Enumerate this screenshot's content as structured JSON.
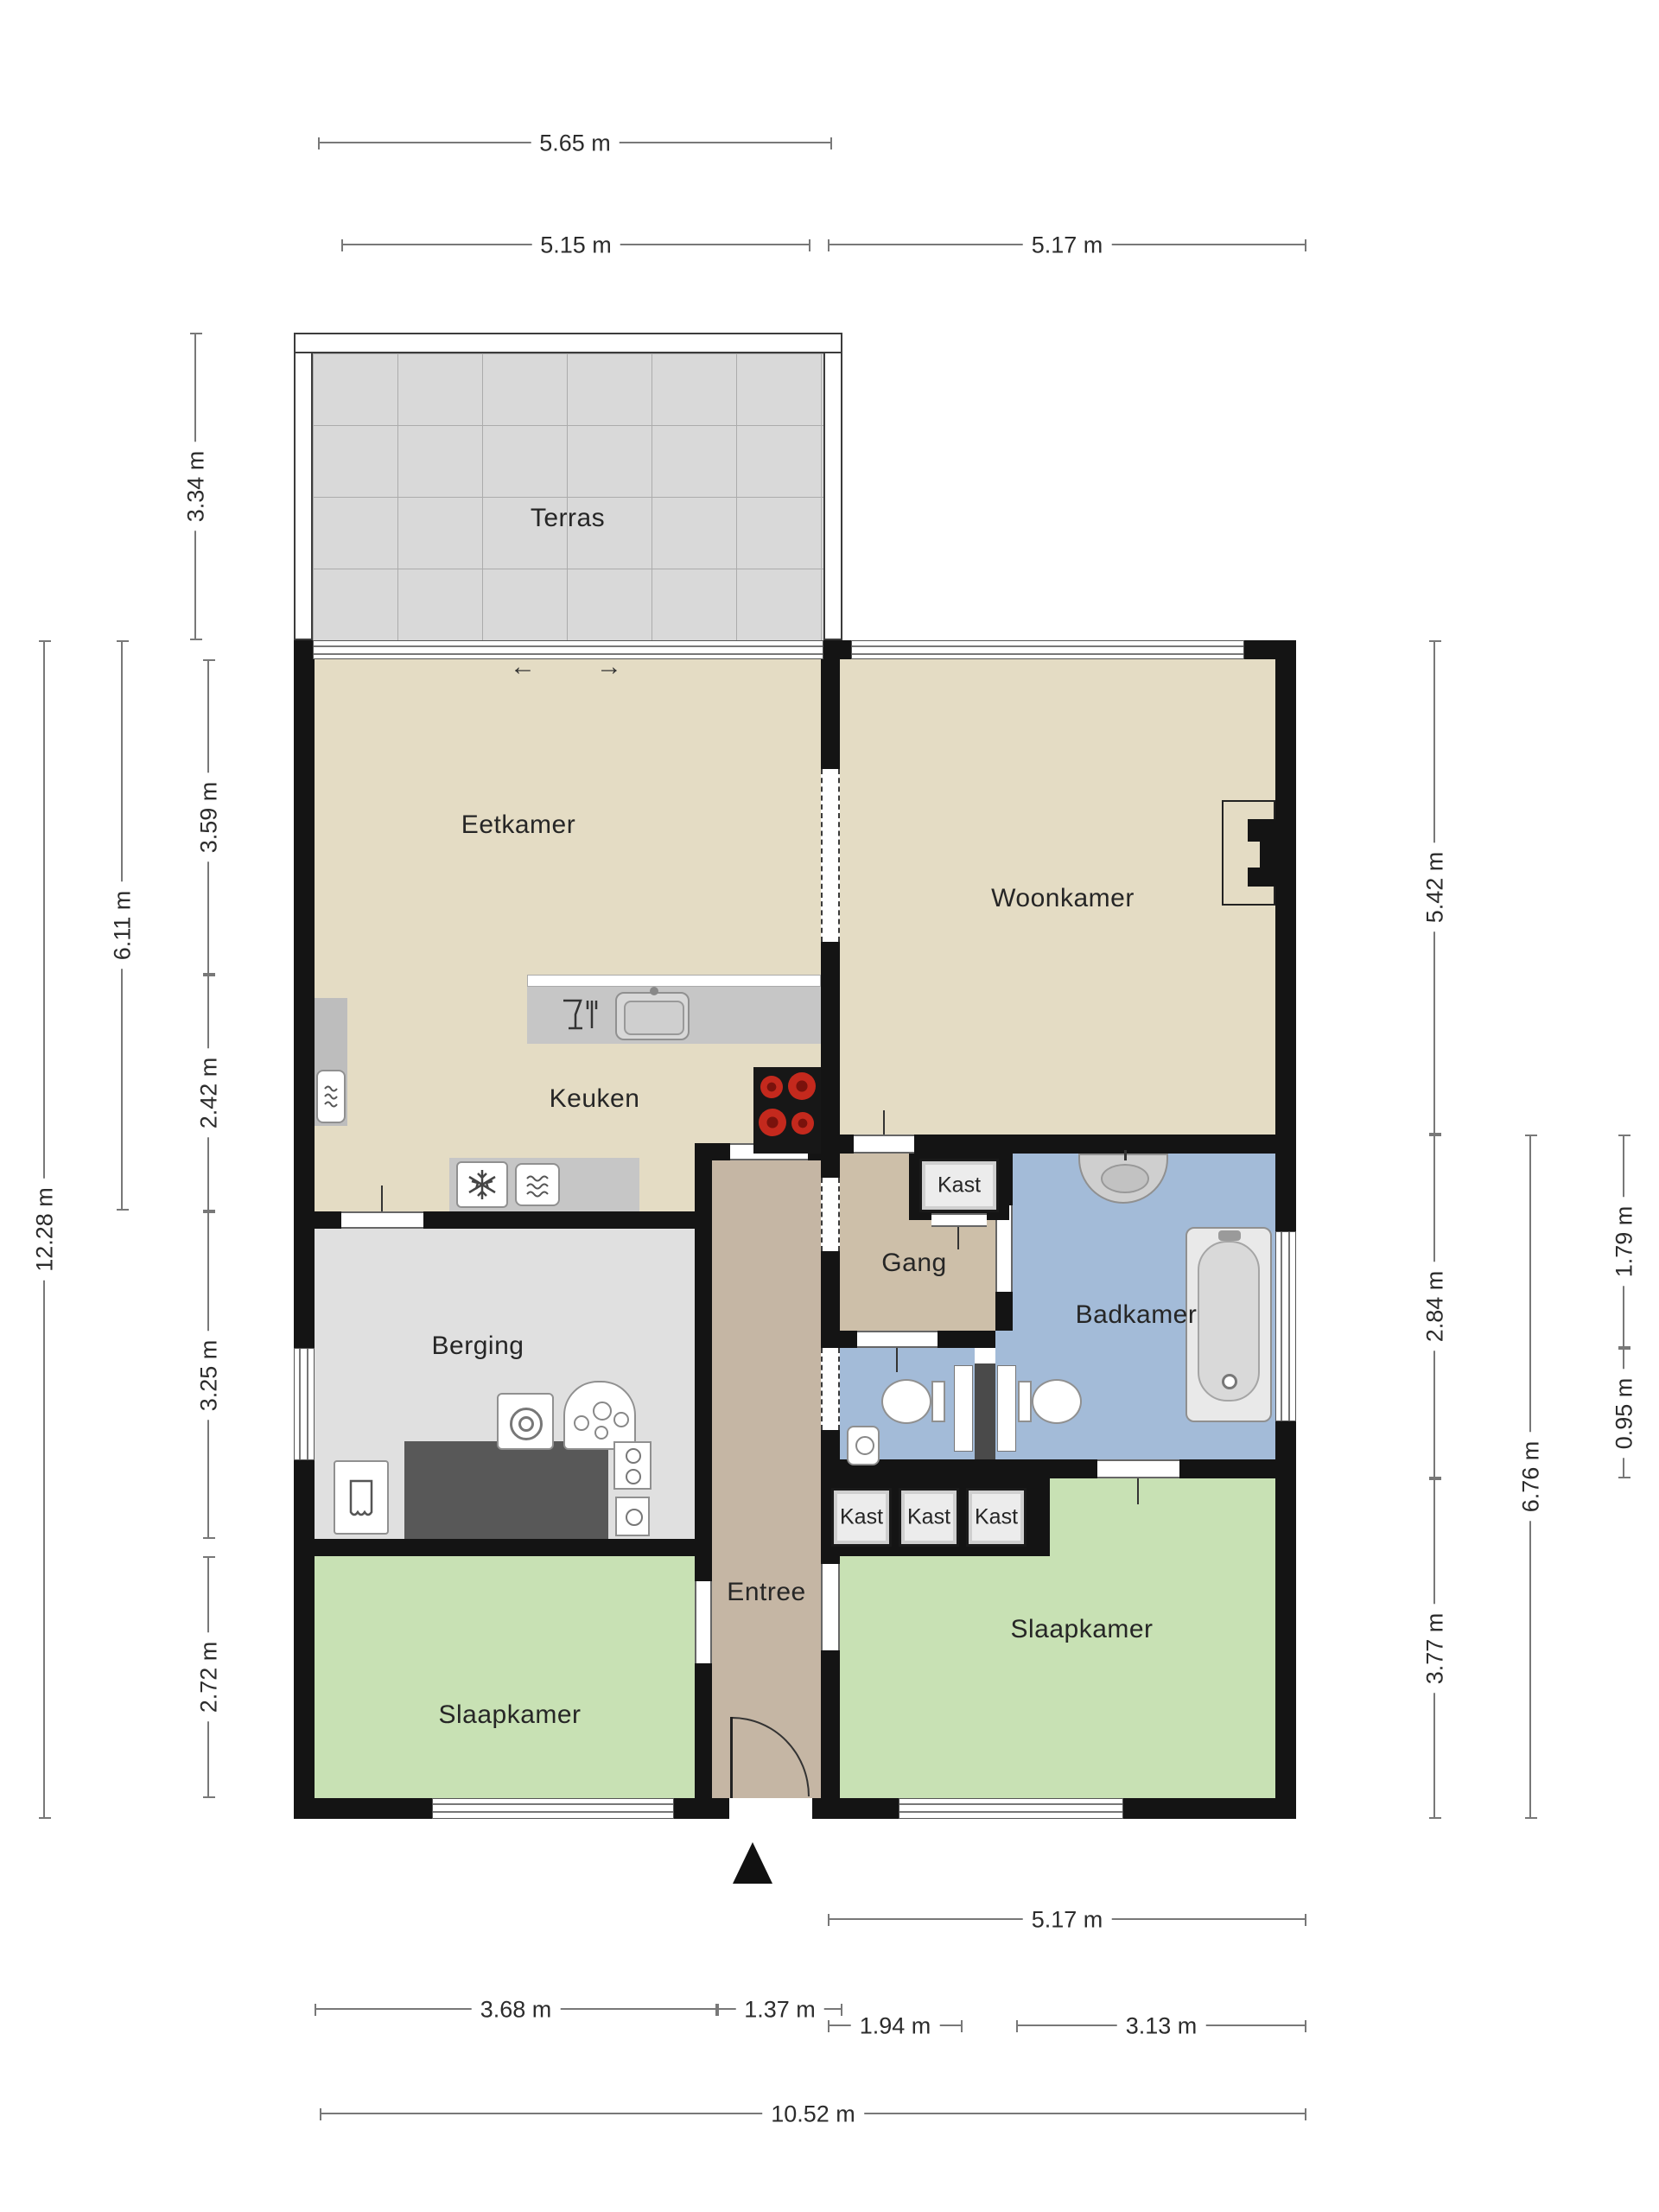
{
  "title": "Floor plan (Dutch apartment)",
  "rooms": {
    "terras": {
      "label": "Terras"
    },
    "eetkamer": {
      "label": "Eetkamer"
    },
    "woonkamer": {
      "label": "Woonkamer"
    },
    "keuken": {
      "label": "Keuken"
    },
    "gang": {
      "label": "Gang"
    },
    "badkamer": {
      "label": "Badkamer"
    },
    "berging": {
      "label": "Berging"
    },
    "entree": {
      "label": "Entree"
    },
    "slaapkamer_left": {
      "label": "Slaapkamer"
    },
    "slaapkamer_right": {
      "label": "Slaapkamer"
    }
  },
  "closets": {
    "gang_top": {
      "label": "Kast"
    },
    "row": [
      {
        "label": "Kast"
      },
      {
        "label": "Kast"
      },
      {
        "label": "Kast"
      }
    ]
  },
  "dims": {
    "top": [
      {
        "label": "5.65 m"
      },
      {
        "label": "5.15 m"
      },
      {
        "label": "5.17 m"
      }
    ],
    "bottom": [
      {
        "label": "3.68 m"
      },
      {
        "label": "1.37 m"
      },
      {
        "label": "5.17 m"
      },
      {
        "label": "1.94 m"
      },
      {
        "label": "3.13 m"
      },
      {
        "label": "10.52 m"
      }
    ],
    "left": [
      {
        "label": "3.34 m"
      },
      {
        "label": "12.28 m"
      },
      {
        "label": "6.11 m"
      },
      {
        "label": "3.59 m"
      },
      {
        "label": "2.42 m"
      },
      {
        "label": "3.25 m"
      },
      {
        "label": "2.72 m"
      }
    ],
    "right": [
      {
        "label": "5.42 m"
      },
      {
        "label": "2.84 m"
      },
      {
        "label": "3.77 m"
      },
      {
        "label": "6.76 m"
      },
      {
        "label": "1.79 m"
      },
      {
        "label": "0.95 m"
      }
    ]
  },
  "icons": {
    "arrow_left": "←",
    "arrow_right": "→"
  },
  "colors": {
    "wall": "#141414",
    "floor_living": "#E4DCC4",
    "terrace_tile": "#D9D9D9",
    "hallway": "#CDBFA9",
    "entree": "#C5B6A4",
    "bathroom": "#A3BBD8",
    "bedroom": "#C8E1B4",
    "storage": "#E0E0E0",
    "counter": "#C6C6C6",
    "counter_dark": "#565656",
    "burner_red": "#C4291D",
    "dim_line": "#787878",
    "dim_text": "#2C2C2C"
  }
}
